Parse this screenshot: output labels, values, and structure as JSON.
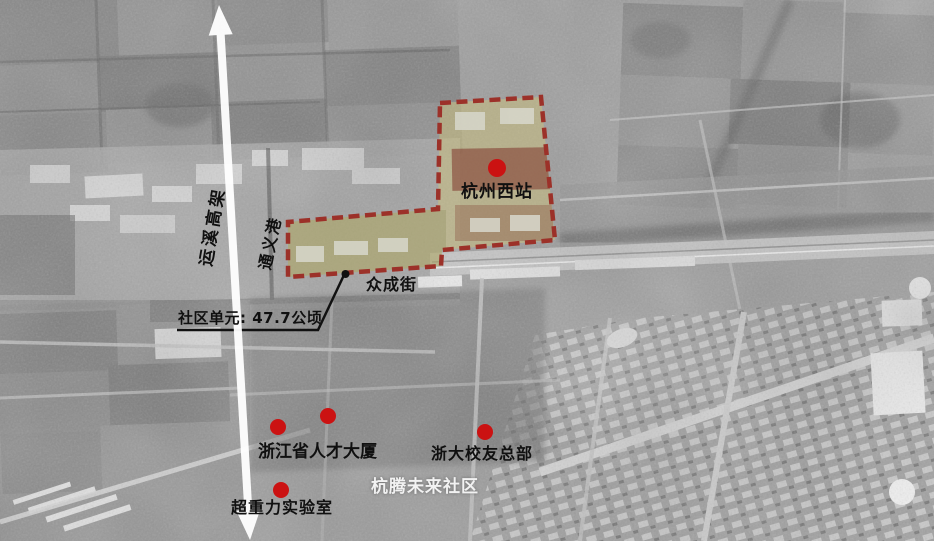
{
  "colors": {
    "marker-dot": "#cb1212",
    "boundary-dash": "#9c3129",
    "zone-highlight": "#cfc27a",
    "label-ink": "#101010",
    "community-ink": "#f2f2f2",
    "arrow-white": "#ffffff"
  },
  "annotations": {
    "station": {
      "text": "杭州西站"
    },
    "area_note": {
      "text": "社区单元: 47.7公顷"
    },
    "street": {
      "text": "众成街"
    },
    "expressway": {
      "text": "运溪高架"
    },
    "canal": {
      "text": "通义港"
    },
    "community": {
      "text": "杭腾未来社区"
    },
    "poi_talent_tower": {
      "text": "浙江省人才大厦"
    },
    "poi_alumni_hq": {
      "text": "浙大校友总部"
    },
    "poi_gravity_lab": {
      "text": "超重力实验室"
    }
  },
  "markers": [
    {
      "id": "station-dot",
      "x": 497,
      "y": 168
    },
    {
      "id": "talent-tower-dot",
      "x": 278,
      "y": 427
    },
    {
      "id": "talent-tower-dot-2",
      "x": 328,
      "y": 416
    },
    {
      "id": "alumni-hq-dot",
      "x": 485,
      "y": 432
    },
    {
      "id": "gravity-lab-dot",
      "x": 281,
      "y": 490
    }
  ]
}
